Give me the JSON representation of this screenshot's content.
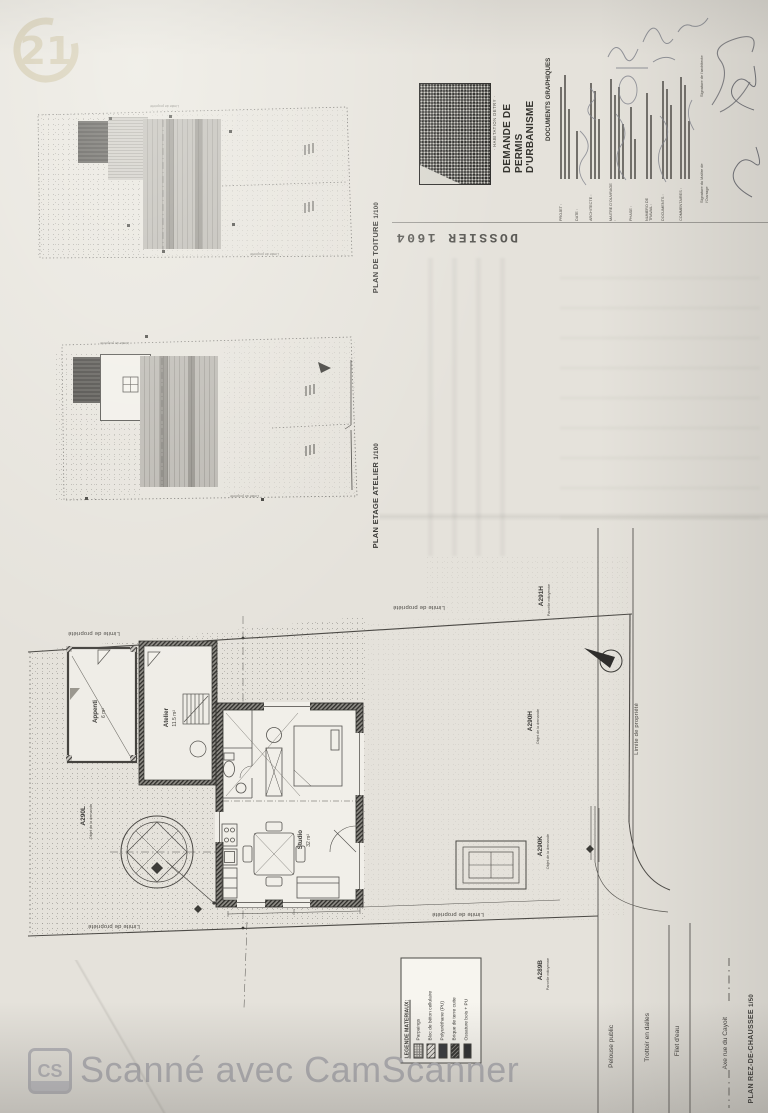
{
  "branding": {
    "century21_logo": "21",
    "camscanner_badge": "CS",
    "camscanner_text": "Scanné avec CamScanner"
  },
  "cartouche": {
    "project_name": "· HABITATION DETRY ·",
    "title_line1": "DEMANDE DE PERMIS",
    "title_line2": "D'URBANISME",
    "subtitle": "DOCUMENTS GRAPHIQUES",
    "dossier_label": "DOSSIER 1604",
    "fields": [
      {
        "label": "PROJET :"
      },
      {
        "label": "DATE :"
      },
      {
        "label": "ARCHITECTE :"
      },
      {
        "label": "MAITRE D'OUVRAGE :"
      },
      {
        "label": "PHASE :"
      },
      {
        "label": "NUMERO DE TRAVAIL :"
      },
      {
        "label": "DOCUMENTS :"
      },
      {
        "label": "COMMENTAIRES :"
      }
    ],
    "signatures": [
      "Signature de l'architecte",
      "Signature du Maître de l'Ouvrage"
    ]
  },
  "plan_titles": {
    "toiture": {
      "name": "PLAN DE TOITURE",
      "scale": "1/100"
    },
    "etage": {
      "name": "PLAN ETAGE ATELIER",
      "scale": "1/100"
    },
    "rdc": {
      "name": "PLAN REZ-DE-CHAUSSEE",
      "scale": "1/50"
    }
  },
  "rooms": {
    "studio": {
      "name": "Studio",
      "area": "32 m²"
    },
    "atelier": {
      "name": "Atelier",
      "area": "11.5 m²"
    },
    "appenti": {
      "name": "Appenti",
      "area": "6 m²"
    }
  },
  "parcels": [
    {
      "id": "A291H",
      "note": "Parcelle mitoyenne"
    },
    {
      "id": "A290H",
      "note": "Objet de la demande"
    },
    {
      "id": "A290K",
      "note": "Objet de la demande"
    },
    {
      "id": "A290L",
      "note": "Objet de la demande"
    },
    {
      "id": "A289B",
      "note": "Parcelle mitoyenne"
    }
  ],
  "boundary_label": "Limite de propriété",
  "street_labels": {
    "pelouse": "Pelouse public",
    "trottoir": "Trottoir en dalles",
    "filet": "Filet d'eau",
    "axe": "Axe rue du Cayoit"
  },
  "legend": {
    "title": "LEGENDE MATERIAUX:",
    "items": [
      {
        "label": "Parpaings"
      },
      {
        "label": "Bloc de béton cellulaire"
      },
      {
        "label": "Polyuréthane (PU)"
      },
      {
        "label": "Brique de terre cuite"
      },
      {
        "label": "Ossature bois + PU"
      }
    ]
  },
  "colors": {
    "paper": "#e5e2db",
    "ink": "#3c3b38",
    "roof_gray": "#a9a6a0",
    "century21_beige": "#cfc6ab",
    "camscanner_gray": "#b2b1b5"
  }
}
